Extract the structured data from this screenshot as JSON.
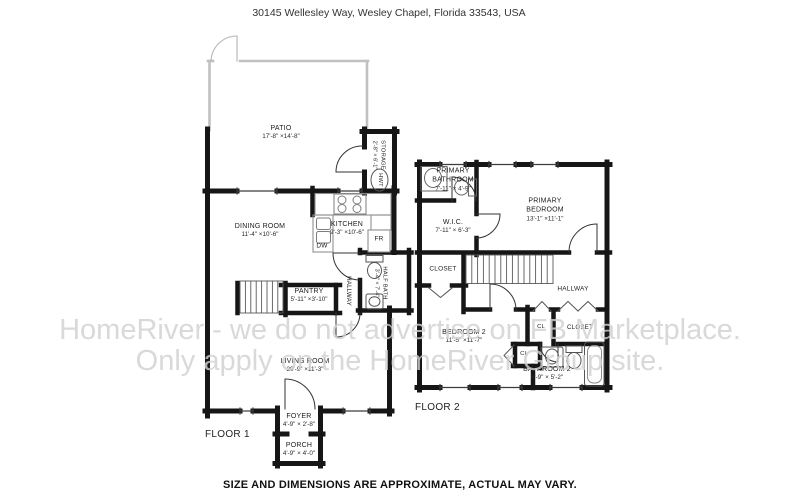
{
  "header": {
    "address": "30145 Wellesley Way, Wesley Chapel, Florida 33543, USA"
  },
  "footer": {
    "disclaimer": "SIZE AND DIMENSIONS ARE APPROXIMATE, ACTUAL MAY VARY."
  },
  "watermark": {
    "line1": "HomeRiver - we do not advertise on FB Marketplace.",
    "line2": "Only apply on the HomeRiver Group site."
  },
  "colors": {
    "wall": "#161616",
    "patio_wall": "#c0c0c0",
    "counter": "#8f8f8f",
    "watermark": "#d1d1d1"
  },
  "floor1": {
    "label": "FLOOR 1",
    "rooms": {
      "patio": {
        "name": "PATIO",
        "dims": "17'-8\" ×14'-8\""
      },
      "storage": {
        "name": "STORAGE",
        "dims": "2'-8\" × 6'-1\""
      },
      "hwt": {
        "name": "HWT"
      },
      "dining": {
        "name": "DINING ROOM",
        "dims": "11'-4\" ×10'-6\""
      },
      "kitchen": {
        "name": "KITCHEN",
        "dims": "9'-3\" ×10'-6\""
      },
      "dw": {
        "name": "DW"
      },
      "fr": {
        "name": "FR"
      },
      "pantry": {
        "name": "PANTRY",
        "dims": "5'-11\" ×3'-10\""
      },
      "hallway": {
        "name": "HALLWAY"
      },
      "halfbath": {
        "name": "HALF BATH",
        "dims": "3'-4\" × 7'-4\""
      },
      "living": {
        "name": "LIVING ROOM",
        "dims": "20'-9\" ×11'-3\""
      },
      "foyer": {
        "name": "FOYER",
        "dims": "4'-9\" × 2'-8\""
      },
      "porch": {
        "name": "PORCH",
        "dims": "4'-9\" × 4'-0\""
      }
    }
  },
  "floor2": {
    "label": "FLOOR 2",
    "rooms": {
      "primary_bathroom": {
        "name": "PRIMARY BATHROOM",
        "dims": "7'-11\" × 4'-9\""
      },
      "primary_bedroom": {
        "name": "PRIMARY BEDROOM",
        "dims": "13'-1\" ×11'-1\""
      },
      "wic": {
        "name": "W.I.C.",
        "dims": "7'-11\" × 6'-3\""
      },
      "closet_upper": {
        "name": "CLOSET"
      },
      "hallway": {
        "name": "HALLWAY"
      },
      "bedroom2": {
        "name": "BEDROOM 2",
        "dims": "11'-5\" ×11'-7\""
      },
      "cl_1": {
        "name": "CL"
      },
      "closet_lower": {
        "name": "CLOSET"
      },
      "cl_2": {
        "name": "CL"
      },
      "bathroom2": {
        "name": "BATHROOM 2",
        "dims": "9'-9\" × 5'-2\""
      }
    }
  }
}
